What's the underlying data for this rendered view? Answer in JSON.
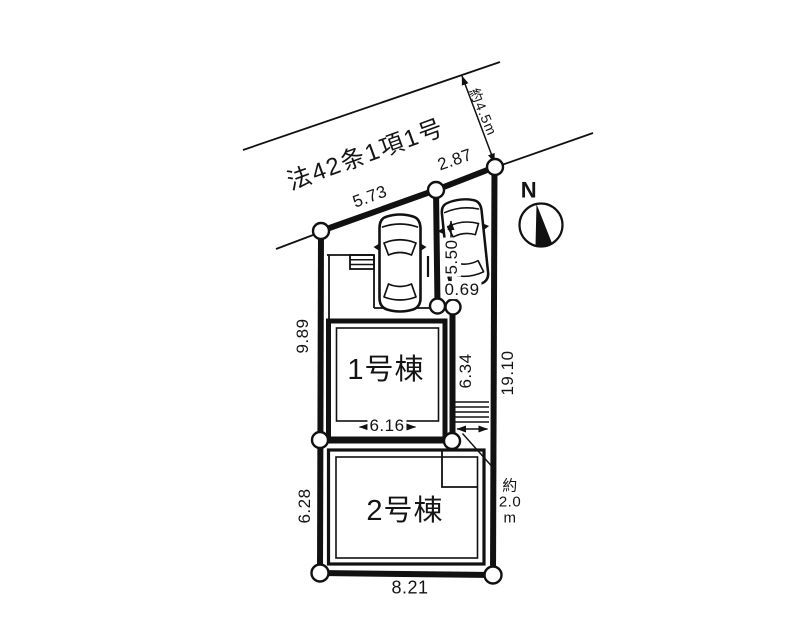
{
  "site_plan": {
    "road": {
      "designation": "法42条1項1号",
      "width_label": "約4.5m"
    },
    "compass": {
      "north": "N"
    },
    "buildings": [
      {
        "label": "1号棟"
      },
      {
        "label": "2号棟"
      }
    ],
    "dimensions": {
      "front_left": "5.73",
      "front_right": "2.87",
      "left_upper": "9.89",
      "left_lower": "6.28",
      "right_side": "19.10",
      "approach_depth": "6.34",
      "building1_width": "6.16",
      "bottom": "8.21",
      "parking_length": "5.50",
      "parking_gap": "0.69",
      "approach_width_lines": [
        "約",
        "2.0",
        "m"
      ]
    },
    "icons": {
      "car": "car-top-view",
      "compass": "north-arrow-compass",
      "corner_marker": "boundary-corner-circle",
      "stairs": "entry-steps"
    },
    "colors": {
      "line": "#111111",
      "background": "#ffffff"
    }
  }
}
